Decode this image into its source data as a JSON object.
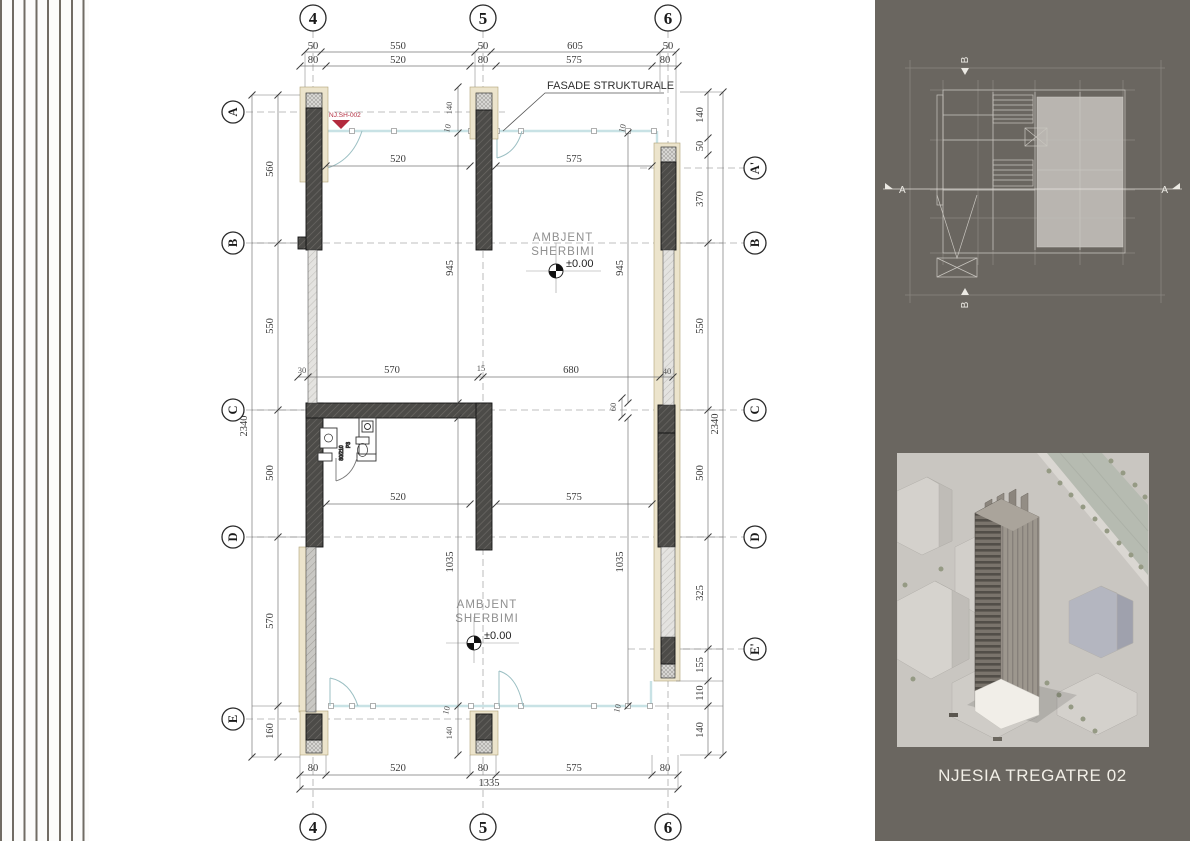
{
  "plan": {
    "title_label": "FASADE STRUKTURALE",
    "unit_marker": "NJ.SH-002",
    "room_label": {
      "line1": "AMBJENT",
      "line2": "SHERBIMI",
      "level": "±0.00"
    },
    "door": {
      "code": "P3",
      "size": "80/210"
    },
    "grid": {
      "cols": [
        "4",
        "5",
        "6"
      ],
      "rows_left": [
        "A",
        "B",
        "C",
        "D",
        "E"
      ],
      "rows_right": [
        "A'",
        "B",
        "C",
        "D",
        "E'"
      ]
    },
    "dims": {
      "top1": [
        "50",
        "550",
        "50",
        "605",
        "50"
      ],
      "top2": [
        "80",
        "520",
        "80",
        "575",
        "80"
      ],
      "bottom": [
        "80",
        "520",
        "80",
        "575",
        "80"
      ],
      "total_w": "1335",
      "left": [
        "560",
        "550",
        "500",
        "570",
        "160"
      ],
      "total_h": "2340",
      "right": [
        "140",
        "50",
        "370",
        "550",
        "500",
        "325",
        "155",
        "110",
        "140"
      ],
      "inner_top": [
        "520",
        "575"
      ],
      "inner_mid": [
        "30",
        "570",
        "15",
        "680",
        "40"
      ],
      "inner_low": [
        "520",
        "575"
      ],
      "glass_upper": "945",
      "glass_lower": "1035",
      "small_140": "140",
      "small_10": "10",
      "small_60": "60"
    }
  },
  "panel": {
    "caption": "NJESIA TREGATRE 02",
    "keyplan": {
      "section_a": "A",
      "section_b": "B"
    }
  },
  "colors": {
    "panel_bg": "#6a6660",
    "wall_dark": "#4c4b48",
    "wall_light": "#e4e3e0",
    "insulation_beige": "#ece4cc",
    "glass": "#c8e2e5",
    "marker_red": "#b32a3d"
  }
}
